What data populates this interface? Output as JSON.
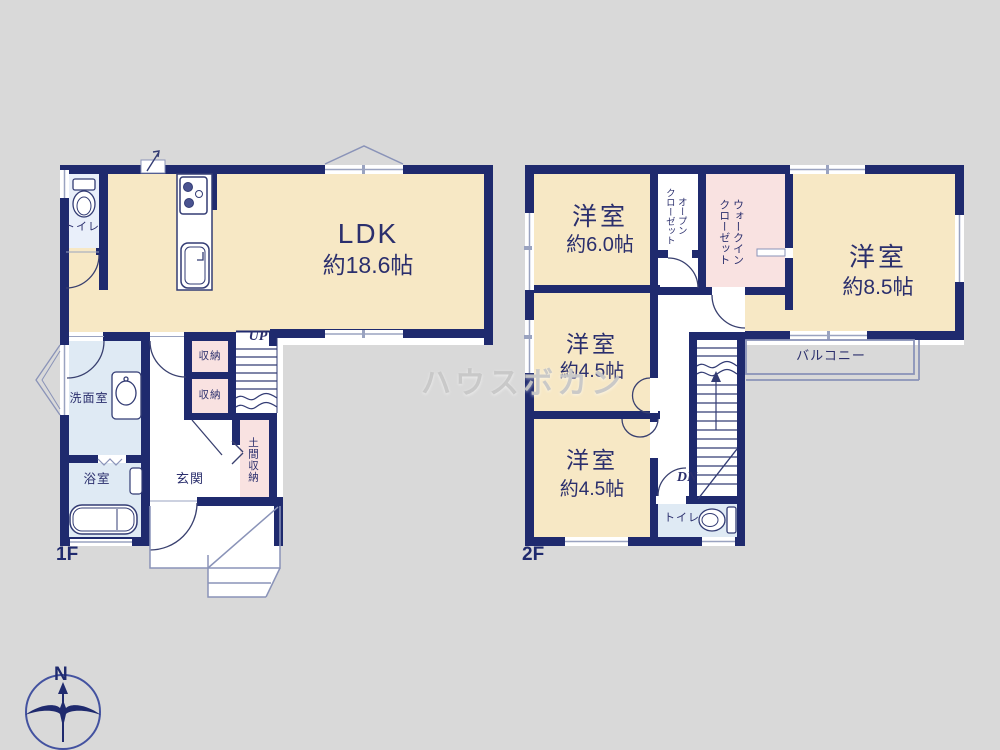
{
  "watermark": {
    "text": "ハウスボカン"
  },
  "compass": {
    "north_label": "N"
  },
  "colors": {
    "background": "#d9d9d9",
    "wall_navy": "#1f2a6e",
    "room_cream": "#f7e8c5",
    "room_pink": "#f9e2e1",
    "room_blue": "#dfeaf4",
    "toilet_blue": "#e9effa",
    "thin_line_gray": "#8a93b8",
    "text_navy": "#2b2f6d",
    "watermark_gray": "#c5c5c5"
  },
  "floor1": {
    "label": "1F",
    "ldk": {
      "name": "LDK",
      "size": "約18.6帖"
    },
    "toilet": {
      "name": "トイレ"
    },
    "washroom": {
      "name": "洗面室"
    },
    "bathroom": {
      "name": "浴室"
    },
    "entrance": {
      "name": "玄関"
    },
    "storage_upper": {
      "name": "収納"
    },
    "storage_lower": {
      "name": "収納"
    },
    "doma_storage": {
      "name": "土間収納"
    },
    "stairs": {
      "label": "UP"
    }
  },
  "floor2": {
    "label": "2F",
    "bedroom_60": {
      "name": "洋室",
      "size": "約6.0帖"
    },
    "open_closet": {
      "line1": "オープン",
      "line2": "クローゼット"
    },
    "walk_in_closet": {
      "line1": "ウォークイン",
      "line2": "クローゼット"
    },
    "bedroom_85": {
      "name": "洋室",
      "size": "約8.5帖"
    },
    "bedroom_45a": {
      "name": "洋室",
      "size": "約4.5帖"
    },
    "bedroom_45b": {
      "name": "洋室",
      "size": "約4.5帖"
    },
    "balcony": {
      "name": "バルコニー"
    },
    "toilet": {
      "name": "トイレ"
    },
    "stairs": {
      "label": "DN"
    }
  }
}
